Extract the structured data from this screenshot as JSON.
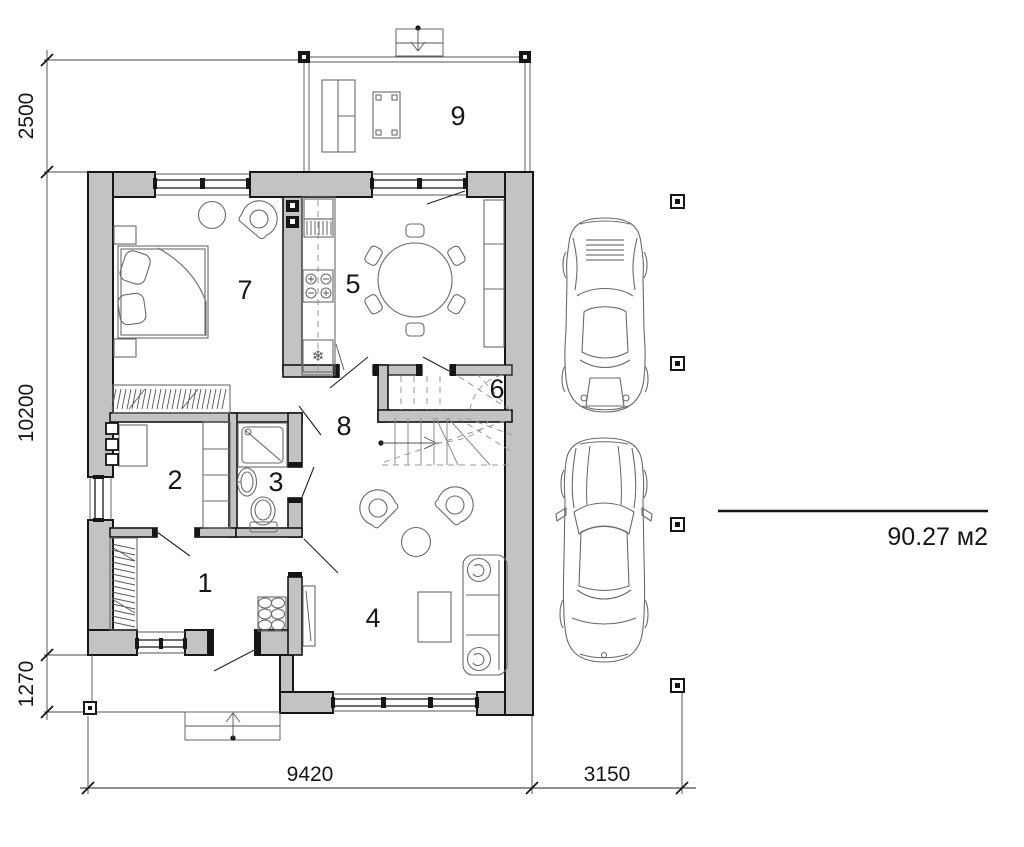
{
  "drawing": {
    "rooms": [
      {
        "label": "1"
      },
      {
        "label": "2"
      },
      {
        "label": "3"
      },
      {
        "label": "4"
      },
      {
        "label": "5"
      },
      {
        "label": "6"
      },
      {
        "label": "7"
      },
      {
        "label": "8"
      },
      {
        "label": "9"
      }
    ],
    "dimensions": {
      "left": [
        "2500",
        "10200",
        "1270"
      ],
      "bottom": [
        "9420",
        "3150"
      ]
    },
    "area_label": "90.27 м2",
    "icons": {
      "snowflake": "❄"
    },
    "colors": {
      "wall_fill": "#c3c3c3",
      "line": "#161616"
    }
  }
}
